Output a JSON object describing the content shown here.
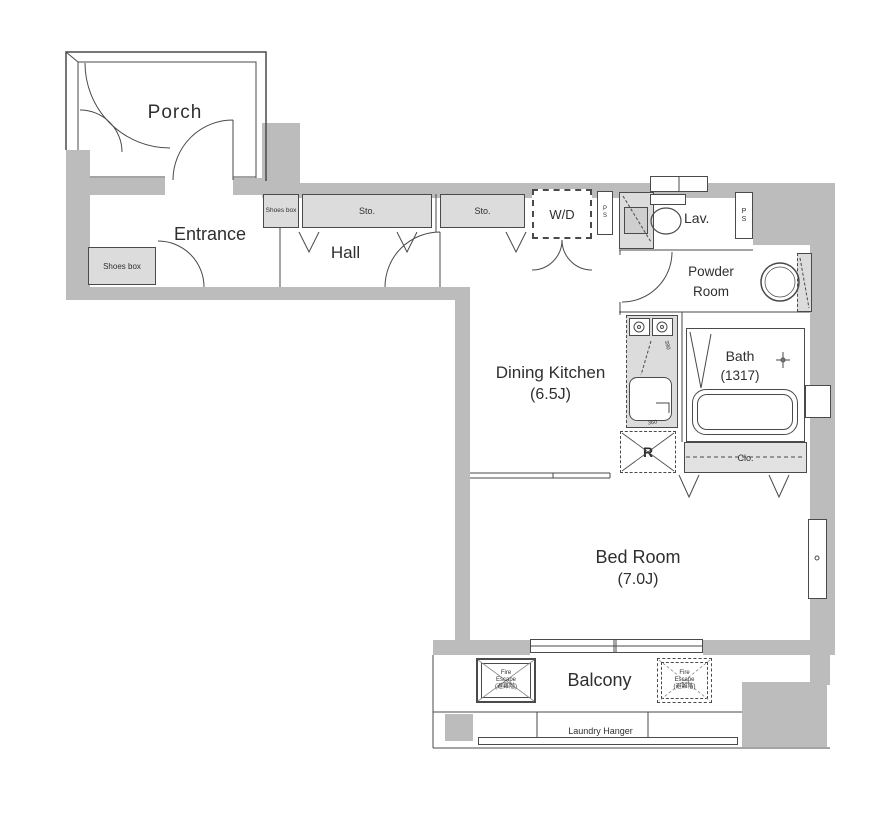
{
  "colors": {
    "wall": "#bcbcbc",
    "fixture": "#dcdcdc",
    "line": "#4a4a4a",
    "background": "#ffffff"
  },
  "rooms": {
    "porch": {
      "label": "Porch"
    },
    "entrance": {
      "label": "Entrance"
    },
    "hall": {
      "label": "Hall"
    },
    "dining_kitchen": {
      "label": "Dining Kitchen",
      "size": "(6.5J)"
    },
    "bed_room": {
      "label": "Bed Room",
      "size": "(7.0J)"
    },
    "balcony": {
      "label": "Balcony"
    },
    "lavatory": {
      "label": "Lav."
    },
    "powder_room": {
      "label": "Powder Room"
    },
    "bath": {
      "label": "Bath",
      "size": "(1317)"
    }
  },
  "fixtures": {
    "shoes_box": "Shoes box",
    "storage": "Sto.",
    "washer_dryer": "W/D",
    "pipe_space": "PS",
    "refrigerator": "R",
    "closet": "Clo.",
    "laundry_hanger": "Laundry Hanger",
    "fire_escape": {
      "line1": "Fire",
      "line2": "Escape",
      "line3": "(避難階)"
    }
  },
  "dimensions": {
    "stove": "390",
    "sink": "360"
  }
}
